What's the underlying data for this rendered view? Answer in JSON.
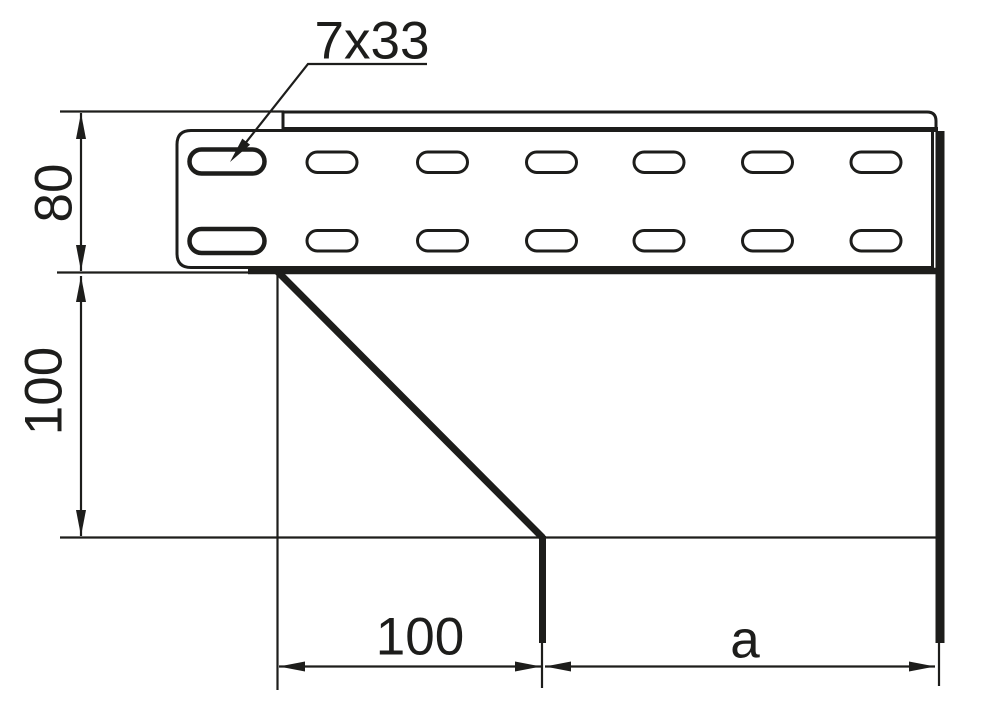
{
  "drawing": {
    "type": "technical-dimension-drawing",
    "labels": {
      "slot_callout": "7x33",
      "rail_height": "80",
      "drop_height": "100",
      "offset_width": "100",
      "variable_width": "a"
    },
    "colors": {
      "line": "#1d1d1b",
      "background": "#ffffff"
    }
  }
}
